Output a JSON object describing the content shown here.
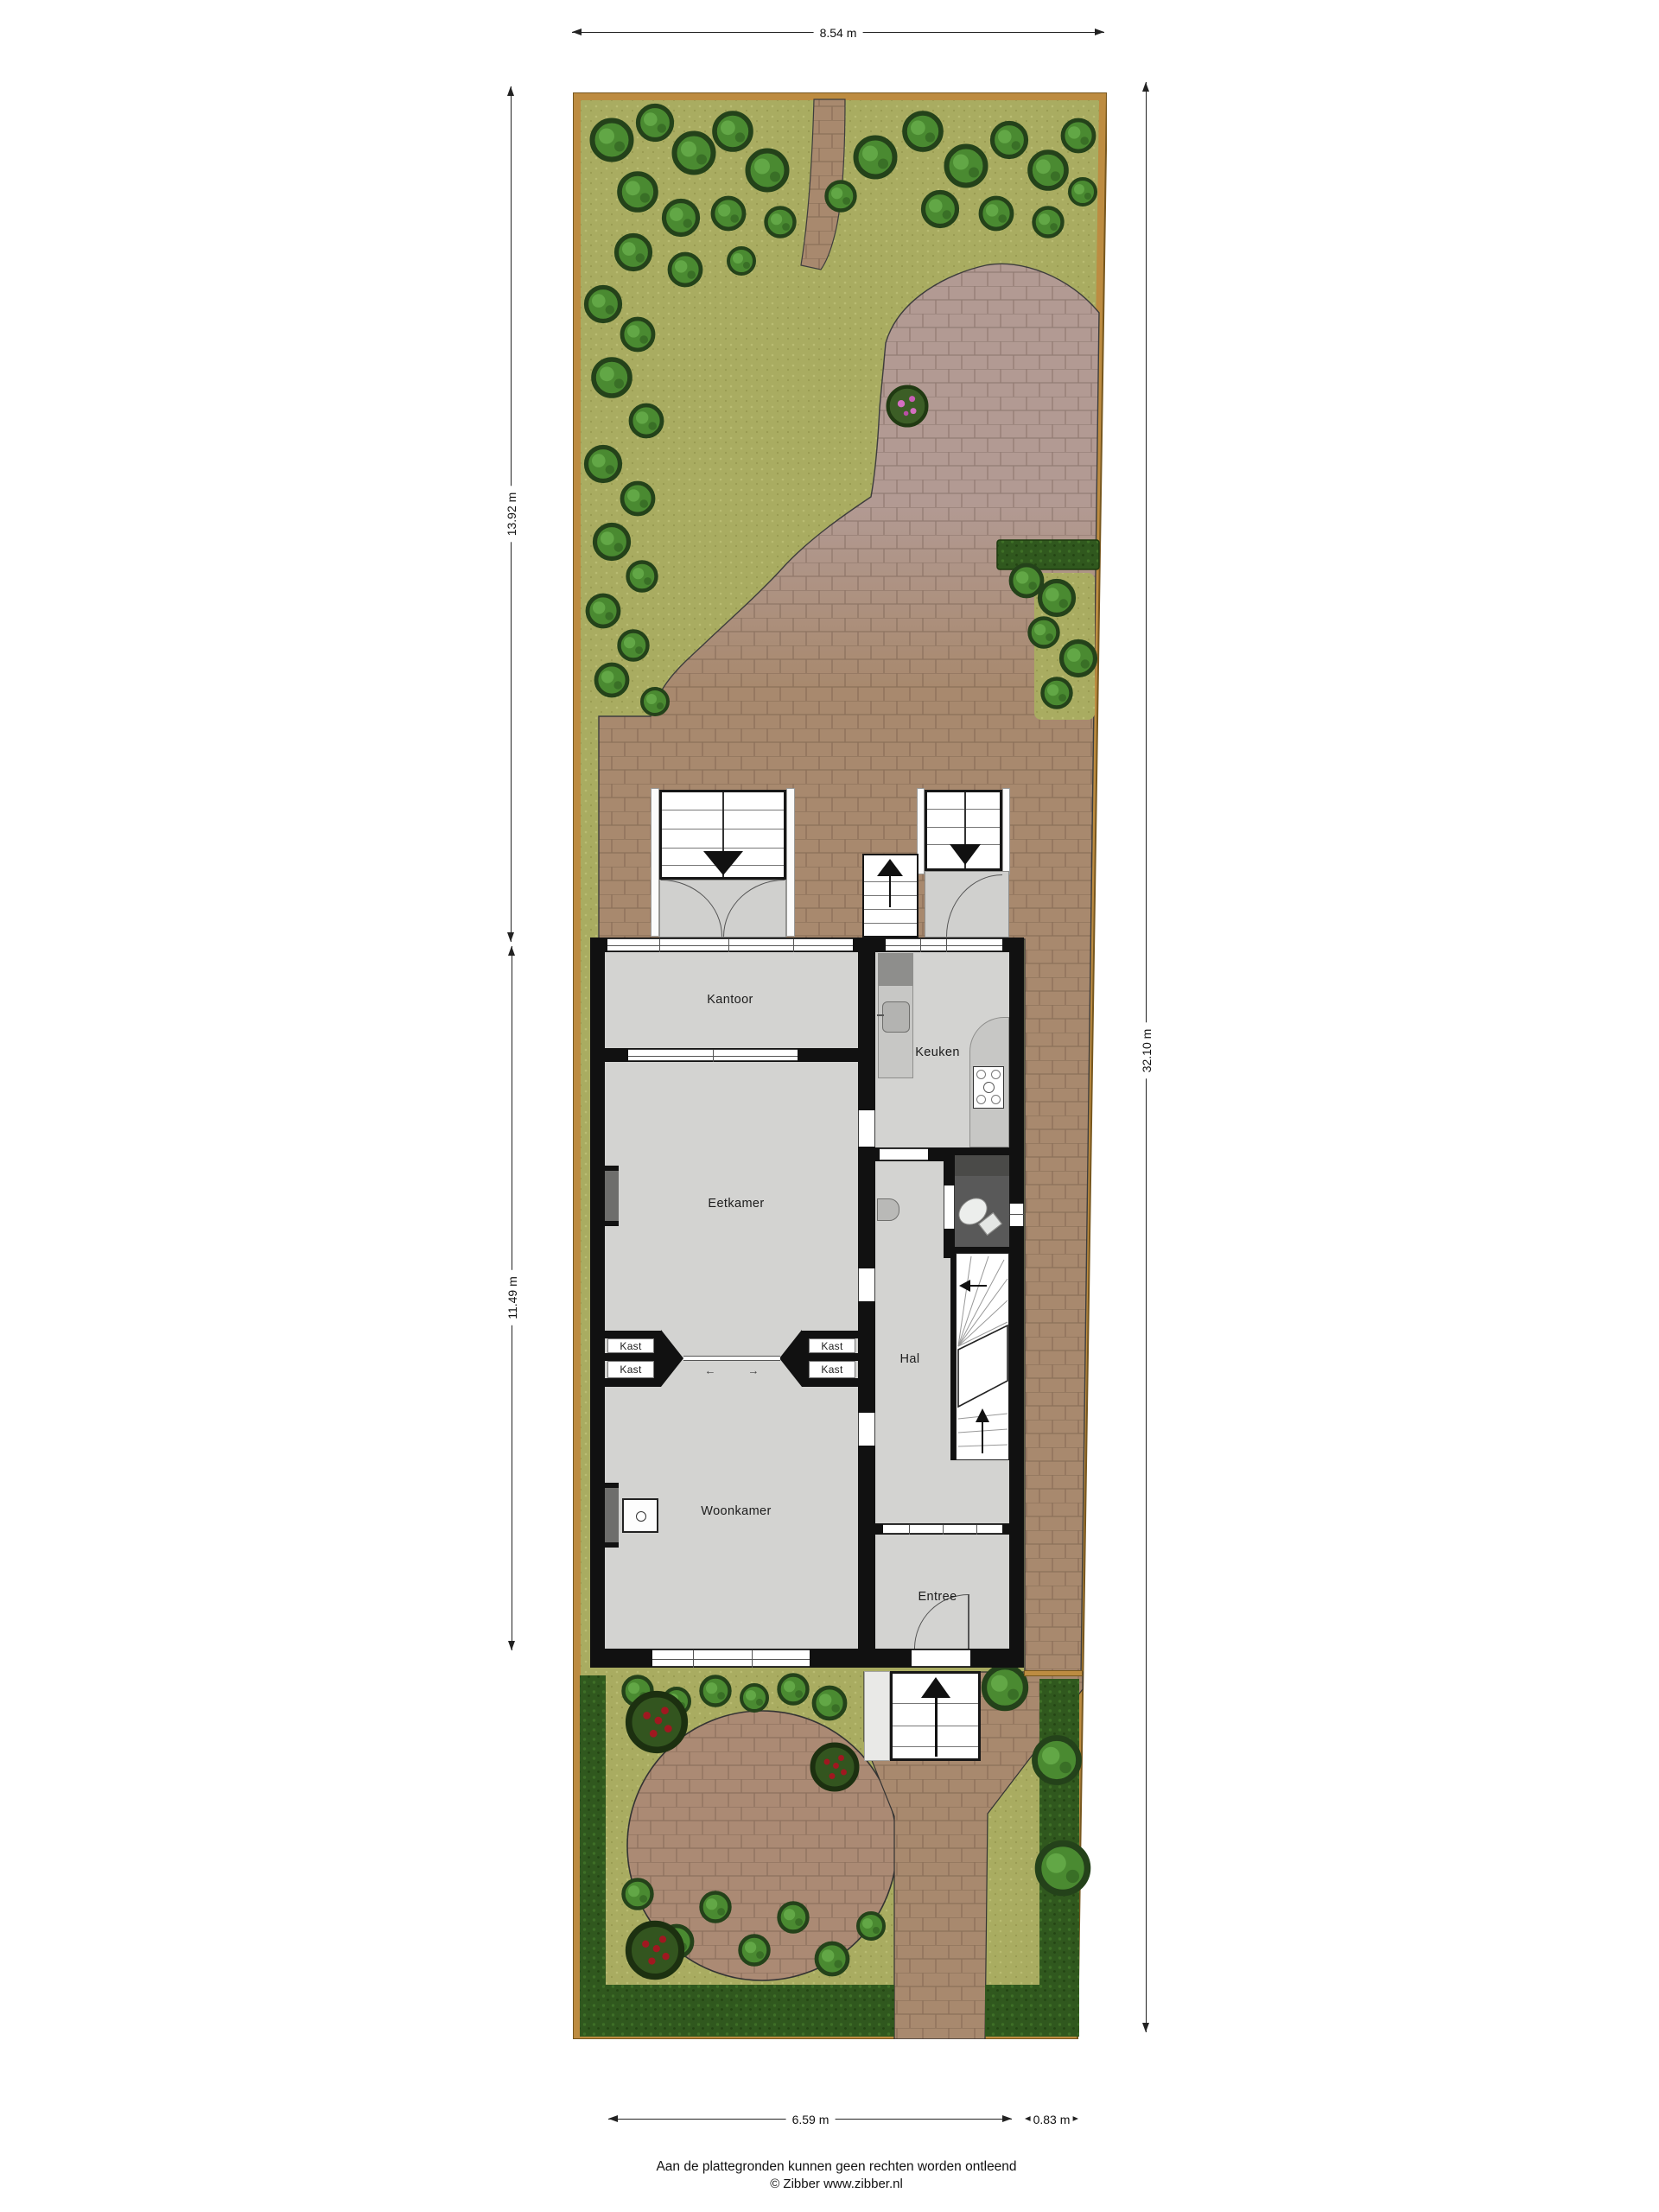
{
  "plan": {
    "dimensions": {
      "top": "8.54 m",
      "left_upper": "13.92 m",
      "left_lower": "11.49 m",
      "right": "32.10 m",
      "bottom_main": "6.59 m",
      "bottom_side": "0.83 m"
    },
    "rooms": {
      "kantoor": "Kantoor",
      "keuken": "Keuken",
      "eetkamer": "Eetkamer",
      "hal": "Hal",
      "woonkamer": "Woonkamer",
      "entree": "Entree",
      "kast1": "Kast",
      "kast2": "Kast",
      "kast3": "Kast",
      "kast4": "Kast"
    },
    "icons": {
      "slide_left": "←",
      "slide_right": "→"
    },
    "footer": {
      "disclaimer": "Aan de plattegronden kunnen geen rechten worden ontleend",
      "copyright": "© Zibber www.zibber.nl"
    },
    "colors": {
      "grass": "#a9ac61",
      "hedge": "#30581e",
      "bush": "#4a8a31",
      "fence": "#bd8c41",
      "paving_warm": "#a8896e",
      "paving_cool": "#b29a93",
      "wall": "#111111",
      "floor": "#d3d3d1",
      "toilet_floor": "#595959"
    }
  }
}
